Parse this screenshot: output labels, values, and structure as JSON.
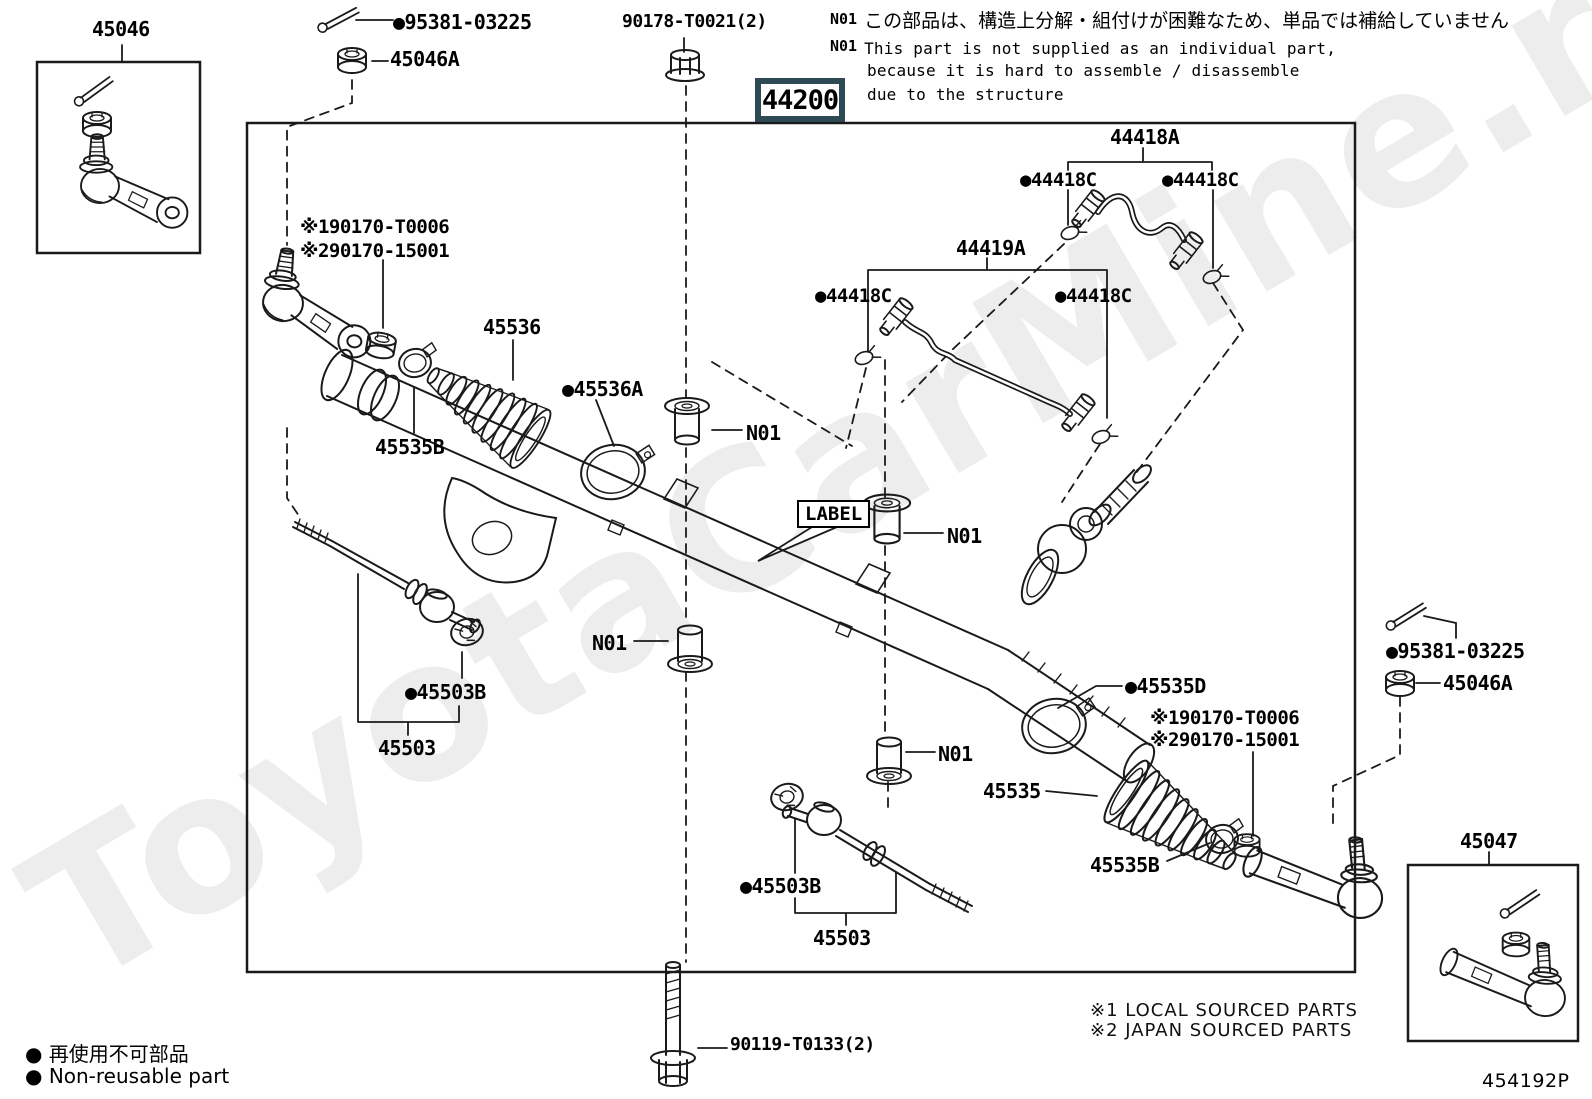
{
  "watermark": "ToyotaCarMine.ru",
  "doc_number": "454192P",
  "main_part_number": "44200",
  "notes": {
    "prefix": "N01",
    "jp": "この部品は、構造上分解・組付けが困難なため、単品では補給していません",
    "en_line1": "This part is not supplied as an individual part,",
    "en_line2": "because it is hard to assemble / disassemble",
    "en_line3": "due to the structure"
  },
  "legend": {
    "bullet": "●",
    "jp": "再使用不可部品",
    "en": "Non-reusable part"
  },
  "sourcing": {
    "line1": "※1 LOCAL SOURCED PARTS",
    "line2": "※2 JAPAN SOURCED PARTS"
  },
  "parts": {
    "p45046": "45046",
    "p95381": "●95381-03225",
    "p45046A": "45046A",
    "p90178": "90178-T0021(2)",
    "p44200": "44200",
    "p44418A": "44418A",
    "p44418C": "●44418C",
    "p44419A": "44419A",
    "p190170": "※190170-T0006",
    "p290170": "※290170-15001",
    "p45536": "45536",
    "p45536A": "●45536A",
    "p45535B": "45535B",
    "pN01": "N01",
    "pLABEL": "LABEL",
    "p45503B": "●45503B",
    "p45503": "45503",
    "p45535D": "●45535D",
    "p45535": "45535",
    "p90119": "90119-T0133(2)",
    "p45047": "45047"
  },
  "colors": {
    "accent_box": "#2d4a56",
    "line": "#1a1a1a",
    "watermark": "#ededed"
  }
}
